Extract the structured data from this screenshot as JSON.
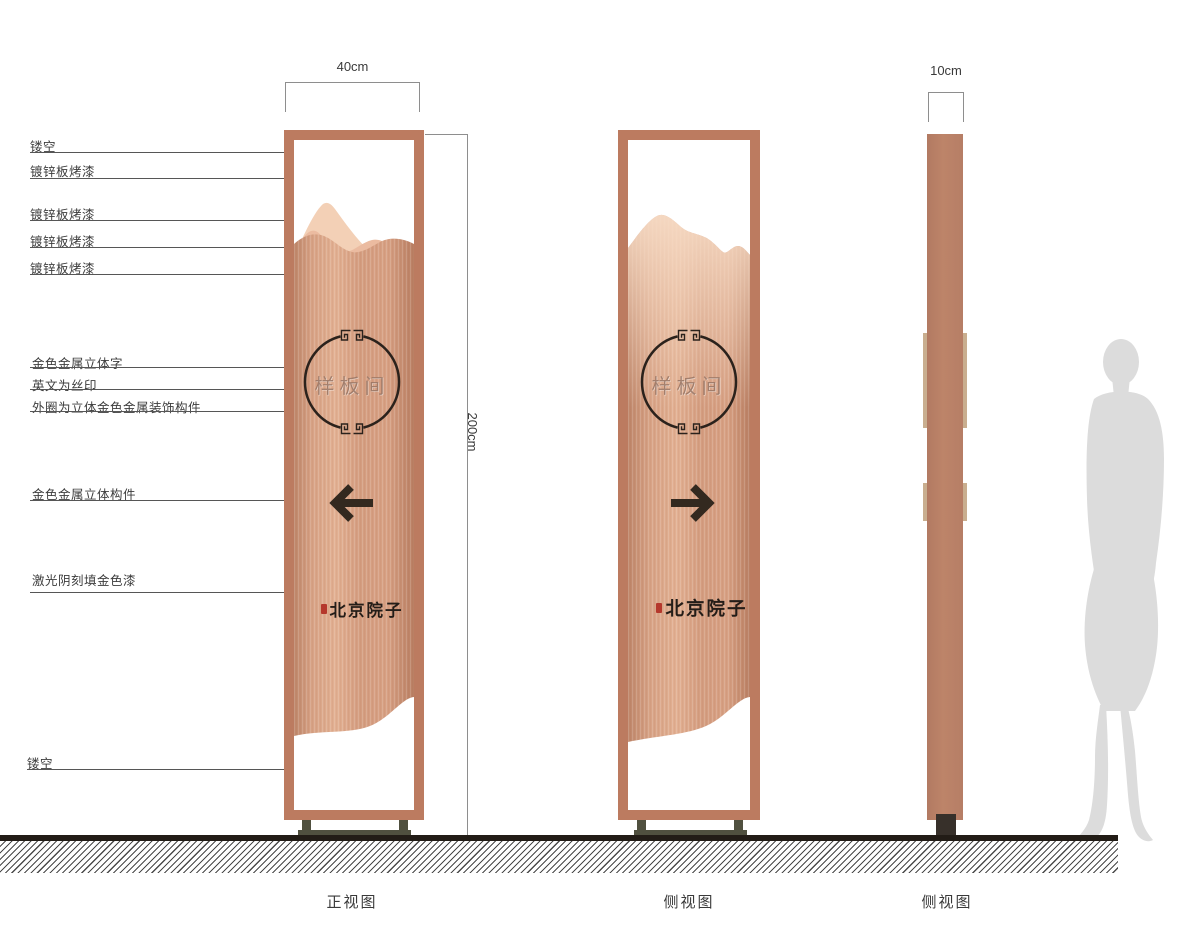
{
  "annotations": {
    "left_labels": [
      "镂空",
      "镀锌板烤漆",
      "镀锌板烤漆",
      "镀锌板烤漆",
      "镀锌板烤漆",
      "金色金属立体字",
      "英文为丝印",
      "外圈为立体金色金属装饰构件",
      "金色金属立体构件",
      "激光阴刻填金色漆",
      "镂空"
    ]
  },
  "dimensions": {
    "front_width": "40cm",
    "side_depth": "10cm",
    "height": "200cm"
  },
  "views": {
    "front_caption": "正视图",
    "side_caption": "侧视图",
    "profile_caption": "侧视图"
  },
  "sign": {
    "circle_text": "样板间",
    "brand_text": "北京院子"
  },
  "colors": {
    "frame": "#bc7b60",
    "panel_mid": "#d49c80",
    "panel_light": "#e2b092",
    "mountain_highlight": "#f3d0b6",
    "ornament_ring": "#2b221c",
    "arrow": "#33291f",
    "brand_ink": "#241d18",
    "seal_red": "#b5382c",
    "base_metal": "#50503f",
    "profile_bar": "#b67f68",
    "profile_trim": "#c9ae8f",
    "silhouette": "#dcdcdc"
  }
}
